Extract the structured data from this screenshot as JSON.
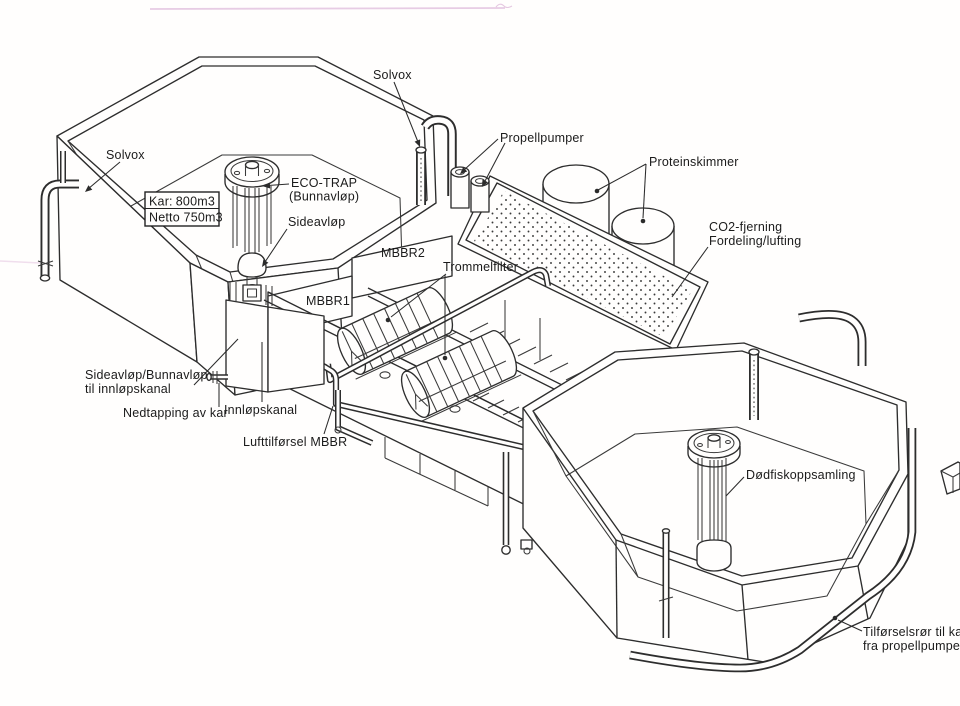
{
  "page": {
    "type": "scanned-technical-diagram",
    "background": "#fffefd"
  },
  "colors": {
    "line": "#2d2d2d",
    "text": "#1b1b1b",
    "scan_artifact_pink": "#d4a3cf",
    "paper": "#fffefd"
  },
  "labels": {
    "solvox_left": "Solvox",
    "solvox_top": "Solvox",
    "kar_prefix": "Kar:",
    "kar_value": "800m3",
    "netto_line": "Netto 750m3",
    "eco_trap_1": "ECO-TRAP",
    "eco_trap_2": "(Bunnavløp)",
    "sideavlop": "Sideavløp",
    "propellpumper": "Propellpumper",
    "proteinskimmer": "Proteinskimmer",
    "co2_1": "CO2-fjerning",
    "co2_2": "Fordeling/lufting",
    "mbbr1": "MBBR1",
    "mbbr2": "MBBR2",
    "trommelfilter": "Trommelfilter",
    "sideavlop_bunnavlop_1": "Sideavløp/Bunnavløp",
    "sideavlop_bunnavlop_2": "til innløpskanal",
    "nedtapping": "Nedtapping av kar",
    "innlopskanal": "Innløpskanal",
    "lufttilforsel": "Lufttilførsel MBBR",
    "dodfiskoppsamling": "Dødfiskoppsamling",
    "tilforselsror_1": "Tilførselsrør til kar",
    "tilforselsror_2": "fra propellpumper"
  }
}
